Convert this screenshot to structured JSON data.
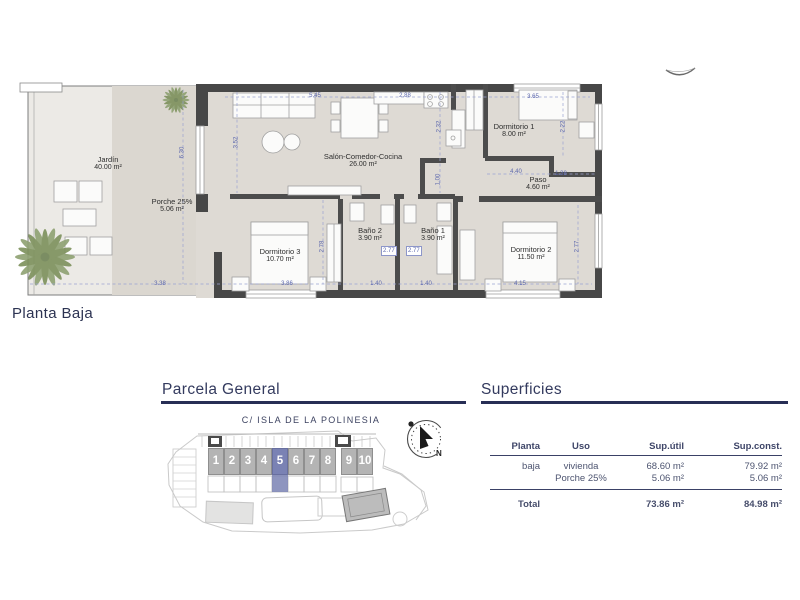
{
  "colors": {
    "accent_navy": "#2e3556",
    "plot_highlight": "#7a82b4",
    "plot_gray": "#b4b4b4",
    "dimension_blue": "#5d68ad",
    "wall_dark": "#474747"
  },
  "floor_plan": {
    "label": "Planta Baja",
    "rooms": [
      {
        "id": "jardin",
        "name": "Jardín",
        "area": "40.00 m²"
      },
      {
        "id": "porche",
        "name": "Porche 25%",
        "area": "5.06 m²"
      },
      {
        "id": "salon",
        "name": "Salón-Comedor-Cocina",
        "area": "26.00 m²"
      },
      {
        "id": "dormitorio-1",
        "name": "Dormitorio 1",
        "area": "8.00 m²"
      },
      {
        "id": "paso",
        "name": "Paso",
        "area": "4.60 m²"
      },
      {
        "id": "dormitorio-3",
        "name": "Dormitorio 3",
        "area": "10.70 m²"
      },
      {
        "id": "bano-2",
        "name": "Baño 2",
        "area": "3.90 m²"
      },
      {
        "id": "bano-1",
        "name": "Baño 1",
        "area": "3.90 m²"
      },
      {
        "id": "dormitorio-2",
        "name": "Dormitorio 2",
        "area": "11.50 m²"
      }
    ],
    "dimensions": [
      "5.45",
      "2.88",
      "2.32",
      "3.65",
      "2.22",
      "3.52",
      "6.30",
      "1.00",
      "4.40",
      "1.38",
      "2.78",
      "3.86",
      "1.40",
      "1.40",
      "2.77",
      "2.77",
      "2.77",
      "4.15",
      "3.38"
    ]
  },
  "parcela": {
    "heading": "Parcela General",
    "street": "C/ ISLA DE LA POLINESIA",
    "plots": [
      "1",
      "2",
      "3",
      "4",
      "5",
      "6",
      "7",
      "8",
      "9",
      "10"
    ],
    "highlighted_plot": "5",
    "compass_label": "N"
  },
  "superficies": {
    "heading": "Superficies",
    "columns": [
      "Planta",
      "Uso",
      "Sup.útil",
      "Sup.const."
    ],
    "rows": [
      {
        "planta": "baja",
        "uso": "vivienda",
        "util": "68.60 m²",
        "const": "79.92 m²"
      },
      {
        "planta": "",
        "uso": "Porche 25%",
        "util": "5.06 m²",
        "const": "5.06 m²"
      }
    ],
    "total": {
      "label": "Total",
      "util": "73.86 m²",
      "const": "84.98 m²"
    }
  }
}
